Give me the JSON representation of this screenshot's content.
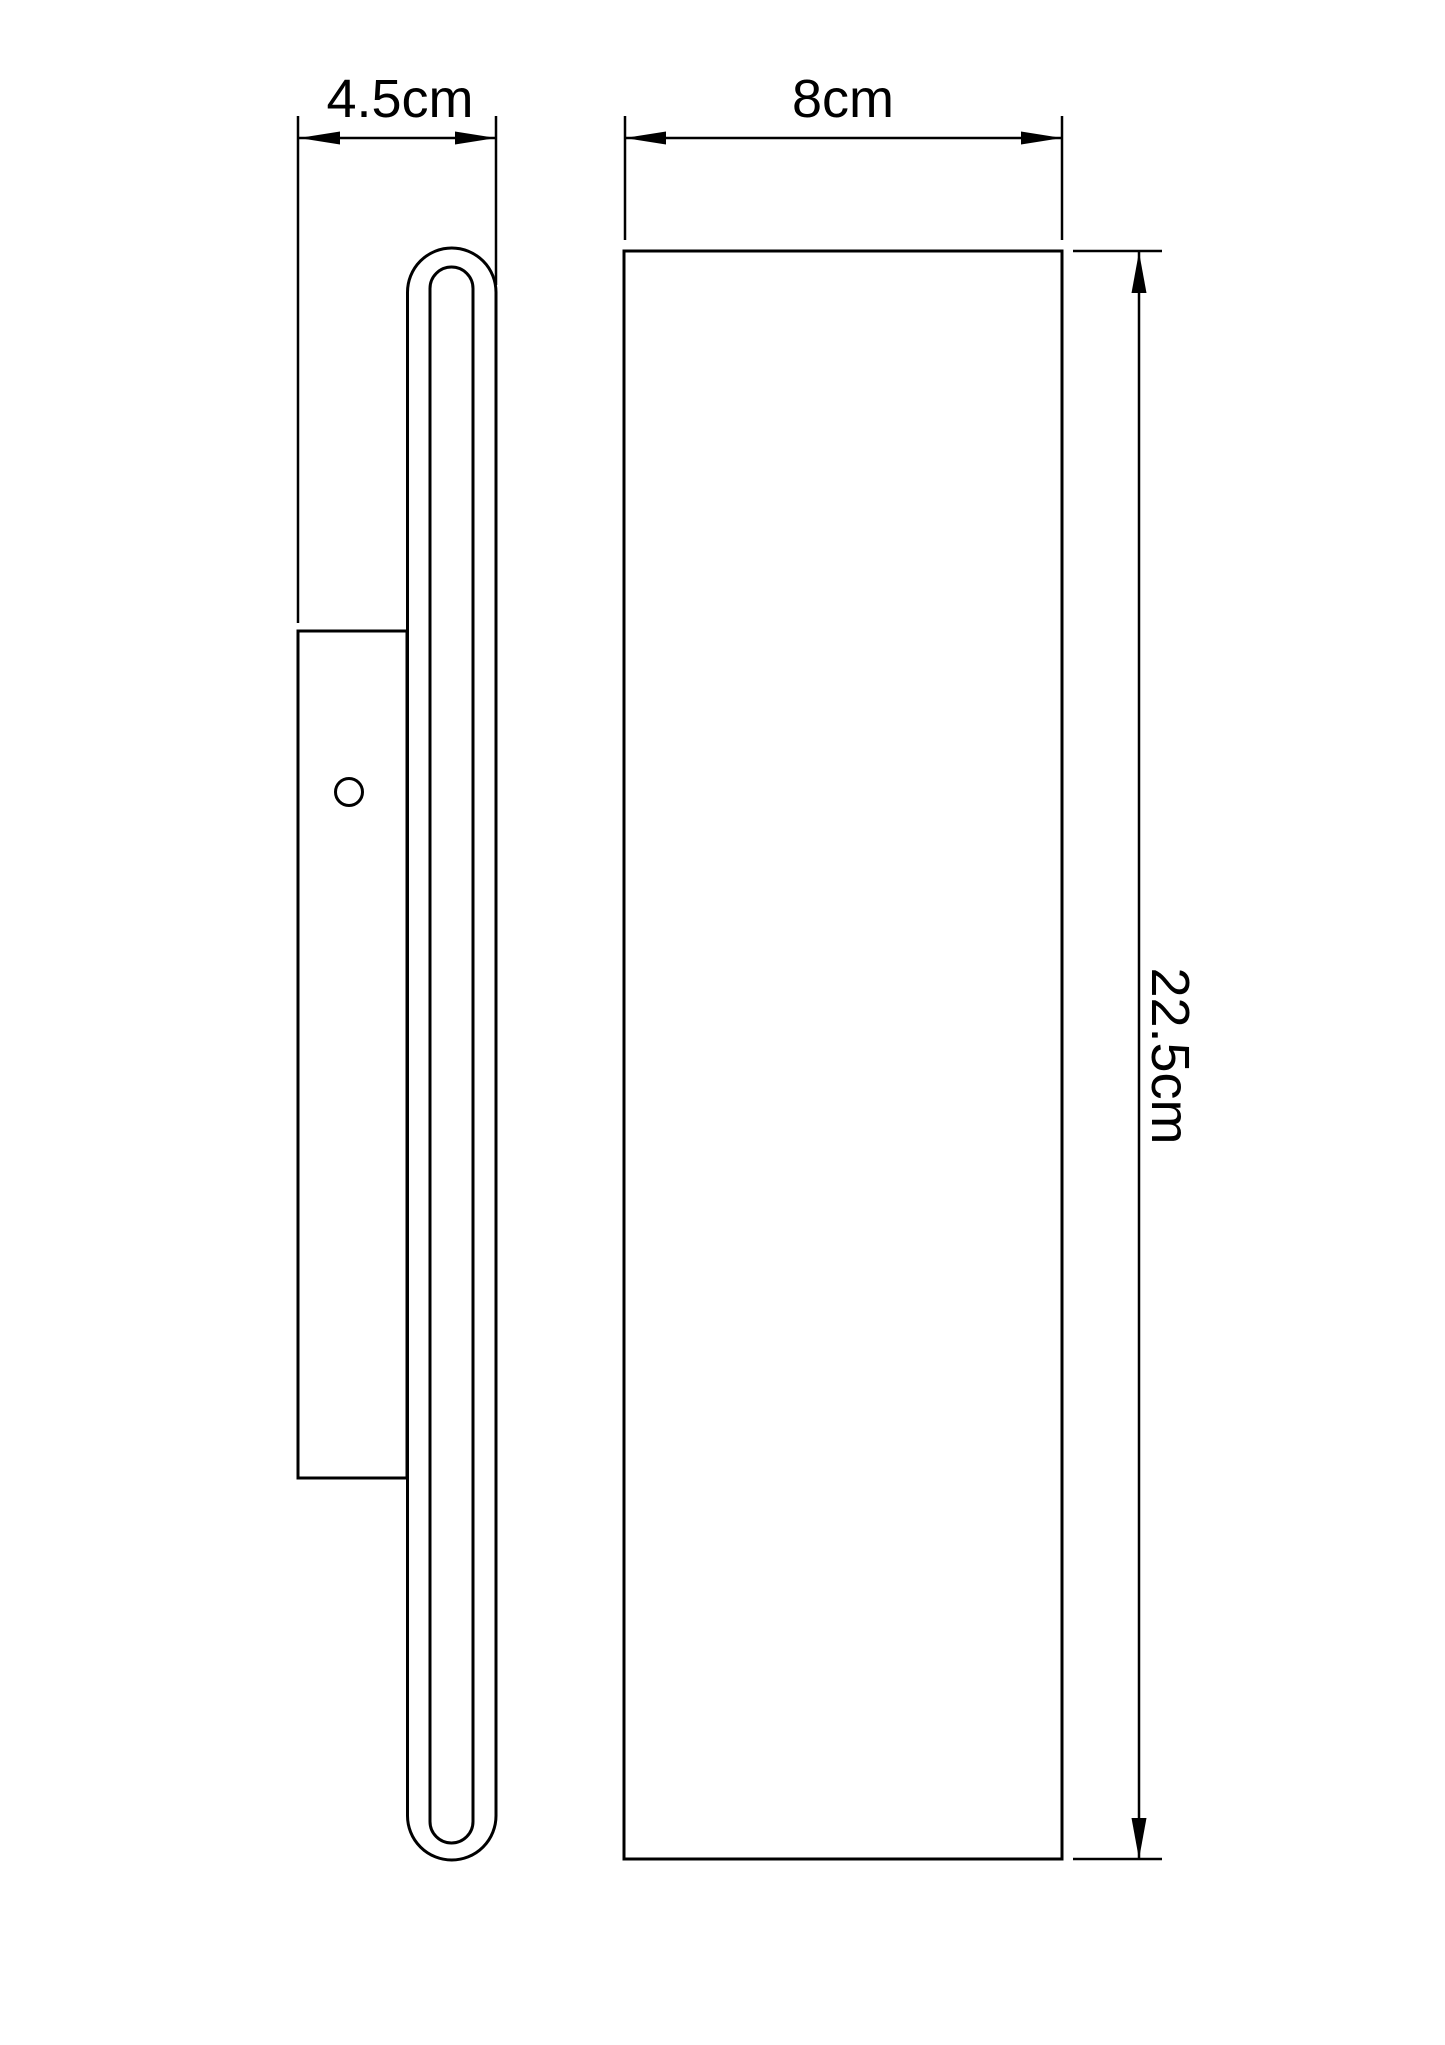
{
  "drawing": {
    "background_color": "#ffffff",
    "line_color": "#000000",
    "views": {
      "side": {
        "width_dimension": {
          "label": "4.5cm"
        }
      },
      "front": {
        "width_dimension": {
          "label": "8cm"
        },
        "height_dimension": {
          "label": "22.5cm"
        }
      }
    }
  }
}
